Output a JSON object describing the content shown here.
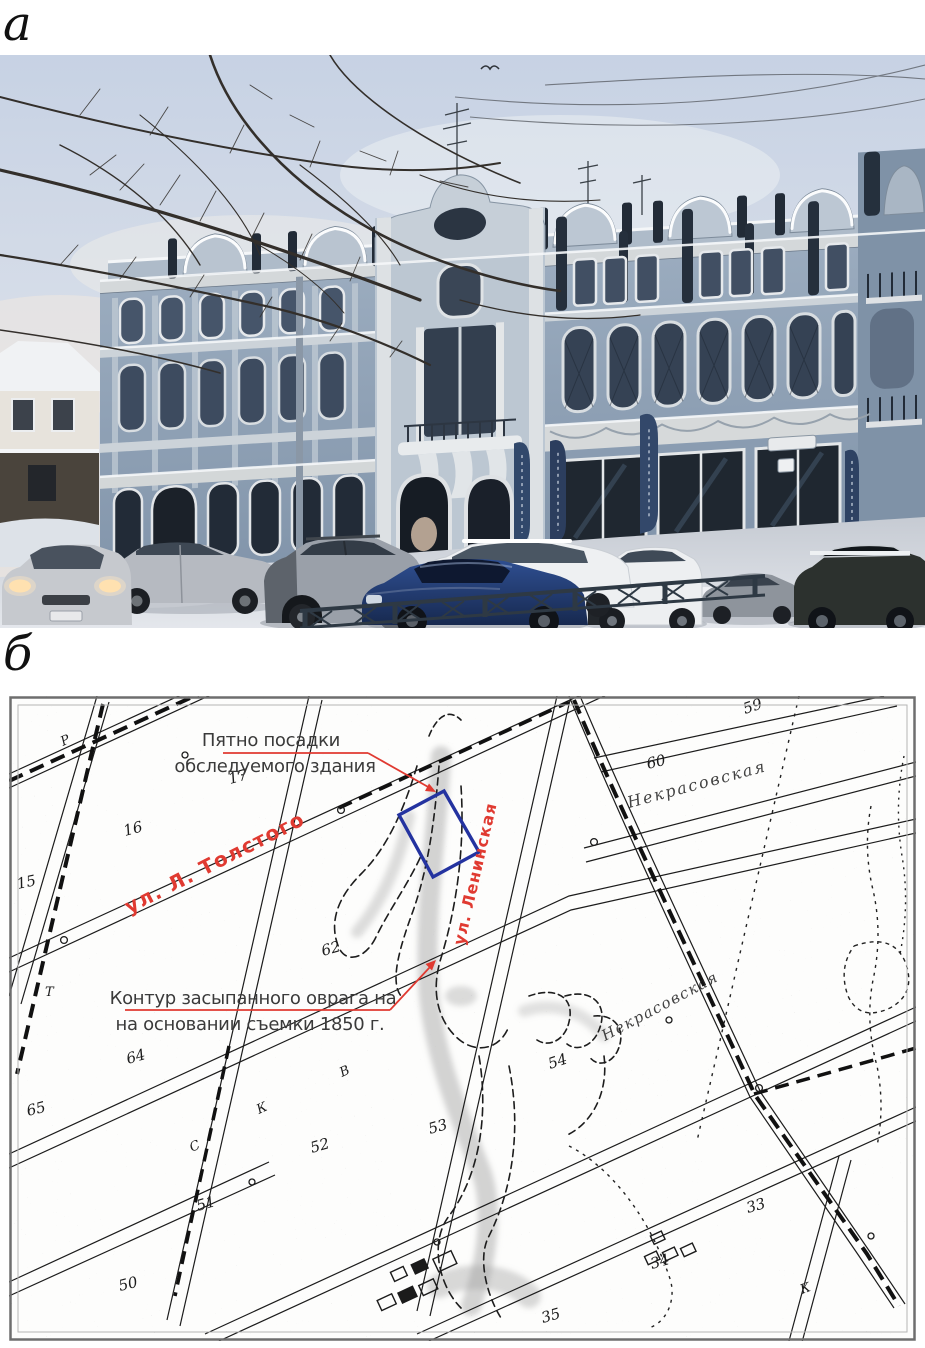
{
  "figure": {
    "label_a": "а",
    "label_b": "б"
  },
  "map": {
    "notes": {
      "building_line1": "Пятно посадки",
      "building_line2": "обследуемого здания",
      "ravine_line1": "Контур засыпанного оврага на",
      "ravine_line2": "на основании съемки 1850 г."
    },
    "streets": {
      "red_1": "ул. Л. Толстого",
      "red_2": "ул. Ленинская",
      "black_1": "Некрасовская",
      "black_2": "Некрасовская"
    },
    "numbers": [
      "15",
      "16",
      "17",
      "59",
      "60",
      "62",
      "64",
      "65",
      "50",
      "51",
      "52",
      "53",
      "54",
      "33",
      "34",
      "35"
    ],
    "letters": [
      "Р",
      "Т",
      "С",
      "К",
      "В",
      "К"
    ],
    "colors": {
      "annotation_red": "#e03a31",
      "footprint_blue": "#2433a0",
      "map_ink": "#1c1c1c"
    }
  }
}
